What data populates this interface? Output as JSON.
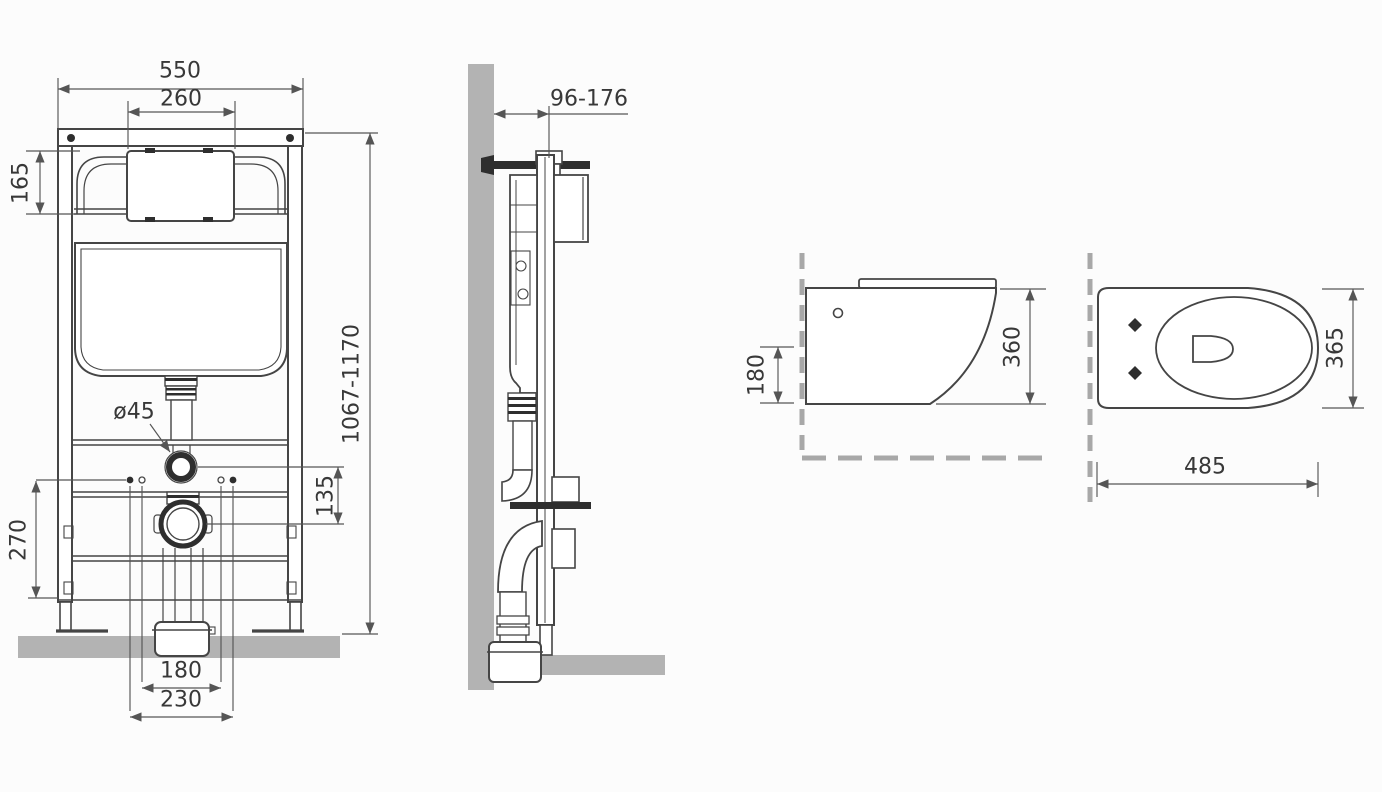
{
  "colors": {
    "background": "#fcfcfc",
    "line": "#454545",
    "dim": "#555555",
    "text": "#383838",
    "gray_fill": "#b3b3b3",
    "dash_gray": "#a8a8a8",
    "dark_fill": "#2e2e2e"
  },
  "views": {
    "frame_front": {
      "dims": {
        "total_width": "550",
        "service_opening_width": "260",
        "service_opening_height": "165",
        "installation_height": "1067-1170",
        "water_inlet_diameter": "ø45",
        "inlet_to_outlet_offset": "135",
        "lower_frame_height": "270",
        "fixing_stud_spacing": "180",
        "outlet_spacing": "230"
      }
    },
    "frame_side": {
      "dims": {
        "wall_clearance_range": "96-176"
      }
    },
    "bowl_side": {
      "dims": {
        "outlet_axis_height": "180",
        "bowl_height": "360"
      }
    },
    "bowl_top": {
      "dims": {
        "bowl_width": "365",
        "bowl_length": "485"
      }
    }
  }
}
